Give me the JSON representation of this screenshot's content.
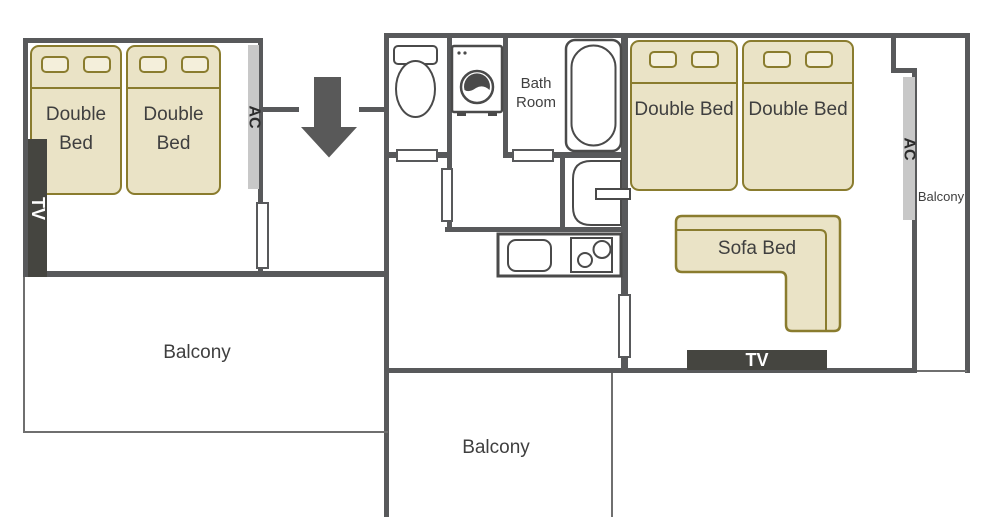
{
  "colors": {
    "wall": "#58595b",
    "wall-thin": "#6f6f6f",
    "bed-fill": "#eae3c6",
    "bed-border": "#8a7c2e",
    "pillow-fill": "#f4efdb",
    "tv-bg": "#454540",
    "tv-text": "#ffffff",
    "ac-bg": "#c8c8c8",
    "label-text": "#3f3f3f",
    "fixture": "#4a4a4a",
    "arrow": "#595959"
  },
  "left_room": {
    "bed1_label": "Double Bed",
    "bed2_label": "Double Bed",
    "tv_label": "TV",
    "ac_label": "AC",
    "balcony_label": "Balcony"
  },
  "middle_section": {
    "bathroom_label": "Bath Room",
    "balcony_label": "Balcony"
  },
  "right_room": {
    "bed1_label": "Double Bed",
    "bed2_label": "Double Bed",
    "sofa_label": "Sofa Bed",
    "tv_label": "TV",
    "ac_label": "AC",
    "balcony_label": "Balcony"
  }
}
